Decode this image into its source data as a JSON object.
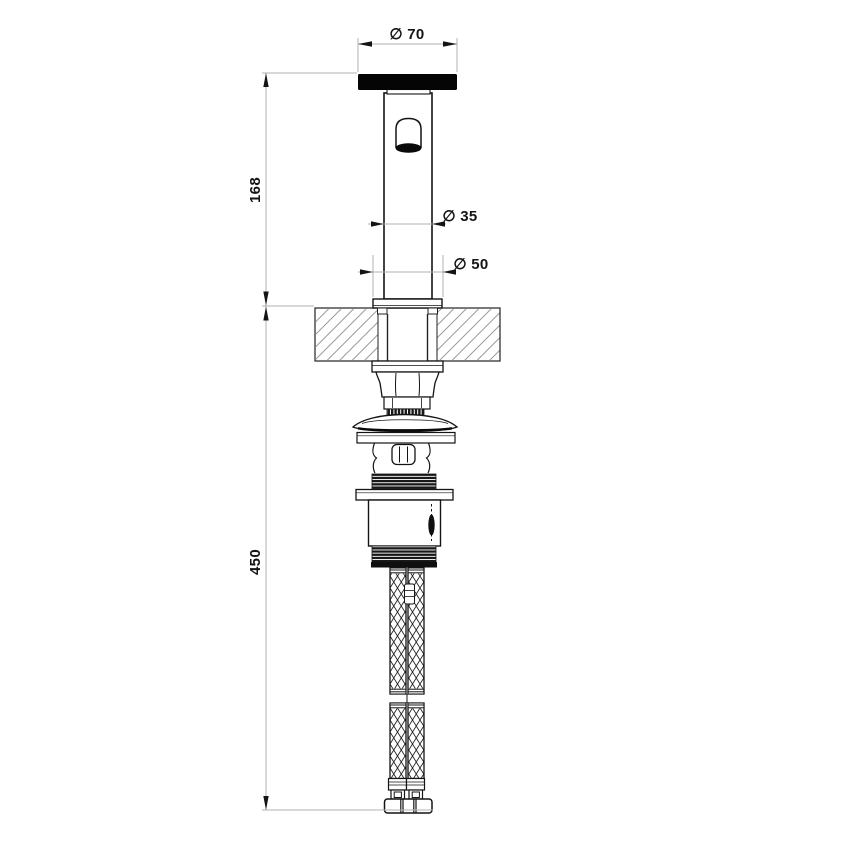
{
  "drawing": {
    "description": "Technical dimension drawing of a deck-mounted basin tap, side elevation with countertop section, mounting hardware and two braided flexible hoses",
    "labels": {
      "dia_top": "∅ 70",
      "dia_body": "∅ 35",
      "dia_base": "∅ 50",
      "height_above_counter": "168",
      "height_below_counter": "450"
    },
    "colors": {
      "object_line": "#141414",
      "dimension_line": "#b2b2b2",
      "hatch_line": "#9c9c9c",
      "solid_fill": "#0a0a0a",
      "background": "#ffffff"
    }
  }
}
